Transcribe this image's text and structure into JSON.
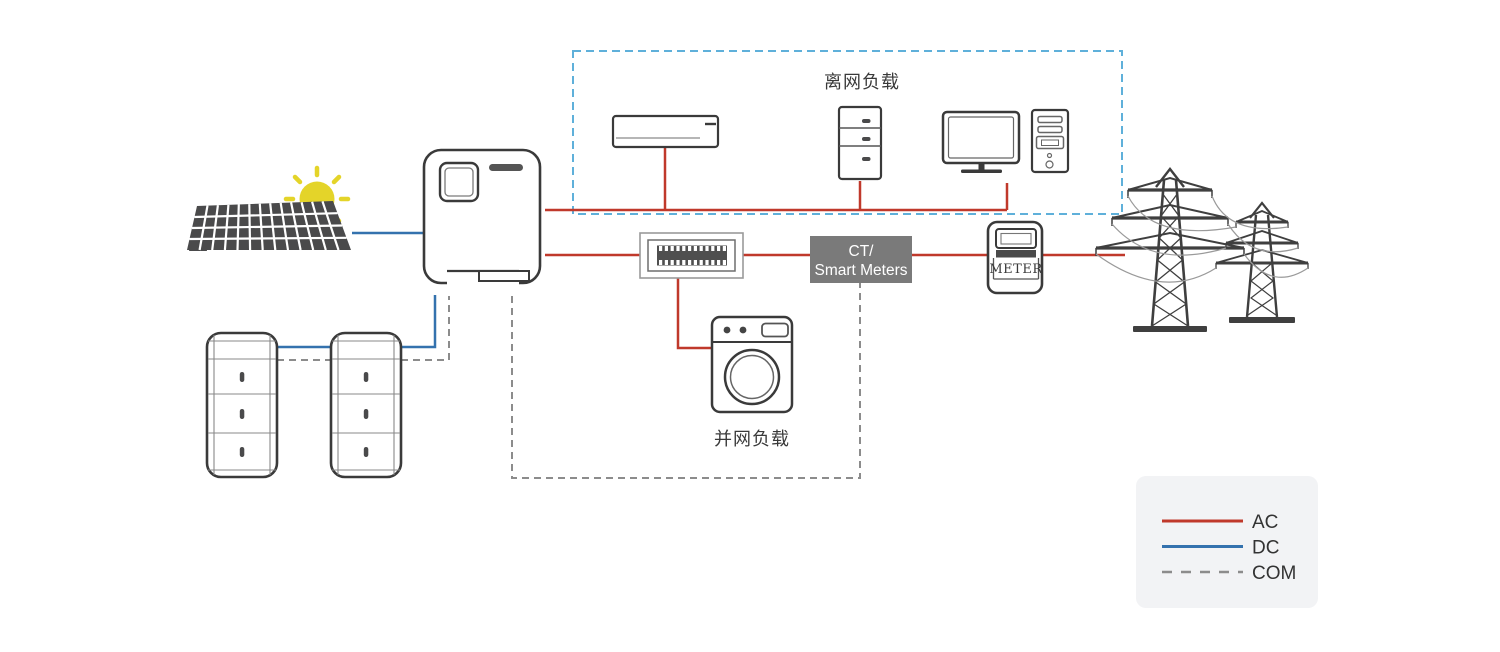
{
  "labels": {
    "offgrid_loads": "离网负载",
    "ongrid_loads": "并网负载",
    "meter": "METER"
  },
  "ct_box": {
    "line1": "CT/",
    "line2": "Smart Meters"
  },
  "legend": {
    "items": [
      {
        "label": "AC",
        "line_style": "solid",
        "color": "#c0392b"
      },
      {
        "label": "DC",
        "line_style": "solid",
        "color": "#3472ae"
      },
      {
        "label": "COM",
        "line_style": "dashed",
        "color": "#8c8c8c"
      }
    ]
  },
  "colors": {
    "ac_red": "#c0392b",
    "dc_blue": "#3472ae",
    "com_gray": "#8c8c8c",
    "zone_blue": "#5fb0da",
    "outline": "#3a3a3a",
    "ct_gray": "#7a7a7a",
    "legend_bg": "#f2f3f5",
    "sun_yellow": "#e4d429",
    "panel_dark": "#4a4a4b"
  },
  "icons": [
    "sun-icon",
    "solar-panel-icon",
    "inverter-icon",
    "battery-tower-icon",
    "air-conditioner-icon",
    "refrigerator-icon",
    "computer-monitor-icon",
    "computer-tower-icon",
    "distribution-box-icon",
    "ct-smart-meter-box",
    "washing-machine-icon",
    "energy-meter-icon",
    "transmission-tower-icon"
  ]
}
